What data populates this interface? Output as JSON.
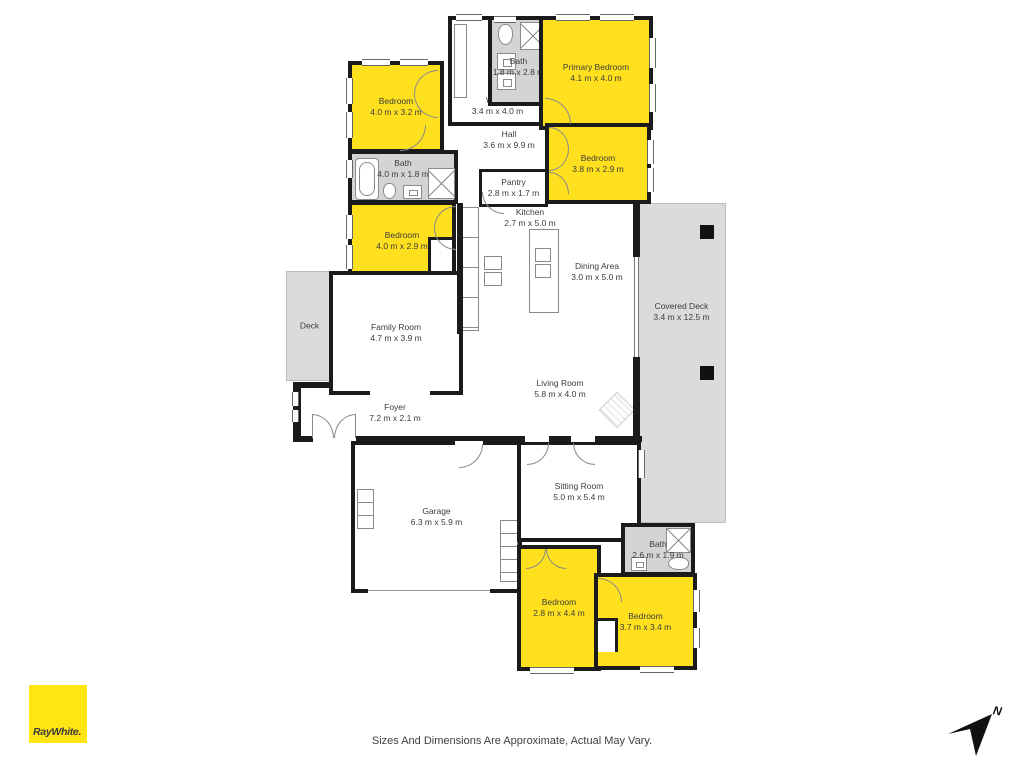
{
  "branding": {
    "logo_text": "RayWhite."
  },
  "footer": {
    "disclaimer": "Sizes And Dimensions Are Approximate, Actual May Vary."
  },
  "compass": {
    "label": "N"
  },
  "colors": {
    "highlight_room": "#FFE01E",
    "logo_yellow": "#FFE512",
    "bath_gray": "#D4D4D4",
    "deck_gray": "#DBDBDB",
    "wall": "#1b1b1b"
  },
  "rooms": [
    {
      "name": "Bedroom",
      "dims": "4.0 m x 3.2 m"
    },
    {
      "name": "Bath",
      "dims": "1.8 m x 2.8 m"
    },
    {
      "name": "W.I.C.",
      "dims": "3.4 m x 4.0 m"
    },
    {
      "name": "Primary Bedroom",
      "dims": "4.1 m x 4.0 m"
    },
    {
      "name": "Bedroom",
      "dims": "3.8 m x 2.9 m"
    },
    {
      "name": "Hall",
      "dims": "3.6 m x 9.9 m"
    },
    {
      "name": "Bath",
      "dims": "4.0 m x 1.8 m"
    },
    {
      "name": "Bedroom",
      "dims": "4.0 m x 2.9 m"
    },
    {
      "name": "Pantry",
      "dims": "2.8 m x 1.7 m"
    },
    {
      "name": "Kitchen",
      "dims": "2.7 m x 5.0 m"
    },
    {
      "name": "Dining Area",
      "dims": "3.0 m x 5.0 m"
    },
    {
      "name": "Covered Deck",
      "dims": "3.4 m x 12.5 m"
    },
    {
      "name": "Deck",
      "dims": ""
    },
    {
      "name": "Family Room",
      "dims": "4.7 m x 3.9 m"
    },
    {
      "name": "Living Room",
      "dims": "5.8 m x 4.0 m"
    },
    {
      "name": "Foyer",
      "dims": "7.2 m x 2.1 m"
    },
    {
      "name": "Garage",
      "dims": "6.3 m x 5.9 m"
    },
    {
      "name": "Sitting Room",
      "dims": "5.0 m x 5.4 m"
    },
    {
      "name": "Bath",
      "dims": "2.6 m x 1.9 m"
    },
    {
      "name": "Bedroom",
      "dims": "2.8 m x 4.4 m"
    },
    {
      "name": "Bedroom",
      "dims": "3.7 m x 3.4 m"
    }
  ]
}
